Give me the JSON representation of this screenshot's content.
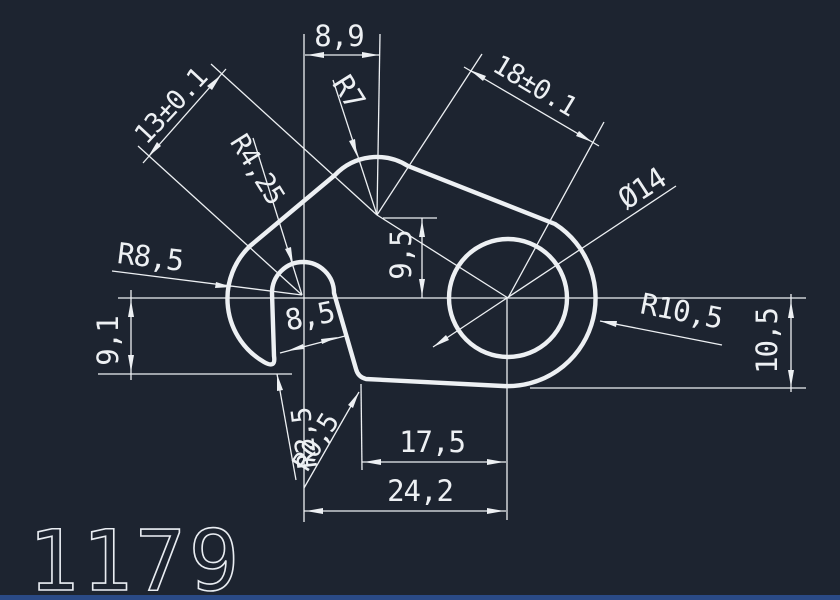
{
  "canvas": {
    "background": "#1d2430",
    "line_color": "#edf0f3",
    "bottom_bar_color": "#2a4a86"
  },
  "title_block": {
    "drawing_number": "1179"
  },
  "dimensions": {
    "top_width": "8,9",
    "left_diagonal_length": "13±0.1",
    "top_fillet_radius": "R7",
    "center_distance": "18±0.1",
    "notch_radius": "R4,25",
    "left_end_radius": "R8,5",
    "apex_height": "9,5",
    "notch_width": "8,5",
    "hole_diameter": "Ø14",
    "right_end_radius": "R10,5",
    "right_height": "10,5",
    "left_height": "9,1",
    "bottom_fillet_radius_a": "R2,5",
    "bottom_fillet_radius_b": "R0,5",
    "bottom_width_inner": "17,5",
    "bottom_width_outer": "24,2"
  }
}
